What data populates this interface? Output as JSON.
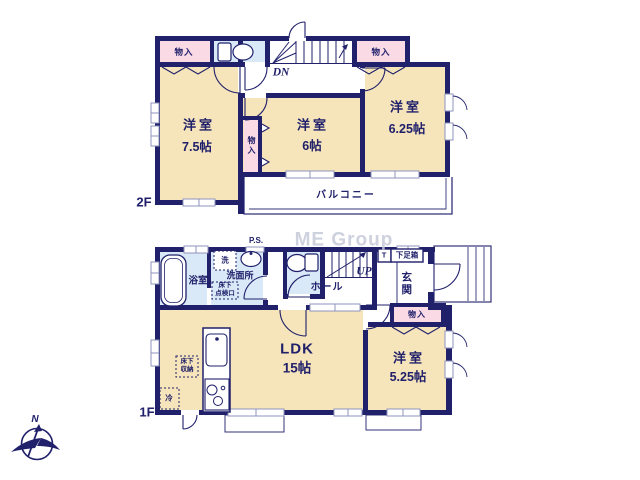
{
  "watermark": "ME Group",
  "compass": {
    "north": "N"
  },
  "colors": {
    "wall": "#20206b",
    "room_fill": "#f6e4ba",
    "closet_fill": "#fadbe5",
    "wet_fill": "#d9e9f7",
    "window_gray": "#8f94bd",
    "watermark_gray": "#c6cad9"
  },
  "floor2": {
    "label": "2F",
    "stairs": "DN",
    "closets": {
      "top_left": "物入",
      "top_right": "物入",
      "middle": "物入"
    },
    "rooms": {
      "west": {
        "name": "洋室",
        "size": "7.5帖"
      },
      "center": {
        "name": "洋室",
        "size": "6帖"
      },
      "east": {
        "name": "洋室",
        "size": "6.25帖"
      }
    },
    "balcony": "バルコニー"
  },
  "floor1": {
    "label": "1F",
    "stairs": "UP",
    "pipe_space": "P.S.",
    "bathroom": "浴室",
    "laundry": "洗",
    "washroom": "洗面所",
    "floor_hatch_line1": "床下",
    "floor_hatch_line2": "点検口",
    "hall": "ホール",
    "toilet_mark": "T",
    "shoe_cabinet": "下足箱",
    "entrance": "玄関",
    "closet": "物入",
    "ldk": {
      "name": "LDK",
      "size": "15帖"
    },
    "room_east": {
      "name": "洋室",
      "size": "5.25帖"
    },
    "floor_storage_line1": "床下",
    "floor_storage_line2": "収納",
    "refrigerator": "冷"
  }
}
